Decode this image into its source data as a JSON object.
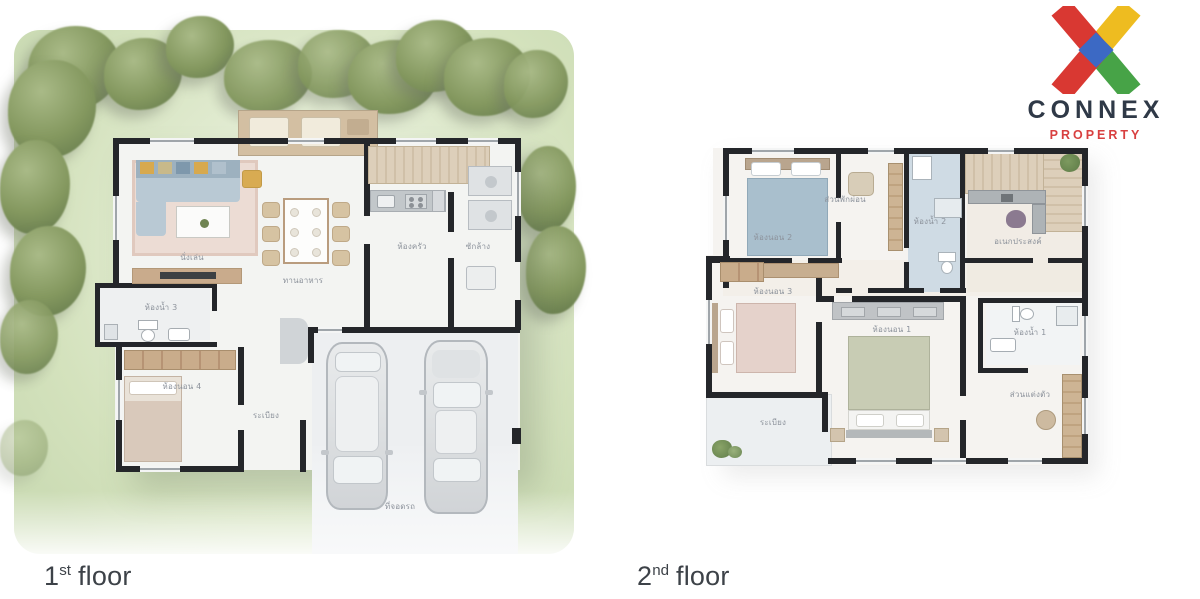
{
  "brand": {
    "logo_text": "CONNEX",
    "logo_subtext": "PROPERTY",
    "x_red": "#d93832",
    "x_yellow": "#eebc20",
    "x_green": "#47a347",
    "x_blue": "#3c69c4",
    "text_color": "#2f3947",
    "subtext_color": "#d84040"
  },
  "captions": {
    "floor1": {
      "number": "1",
      "ordinal": "st",
      "word": "floor"
    },
    "floor2": {
      "number": "2",
      "ordinal": "nd",
      "word": "floor"
    }
  },
  "floor1": {
    "rooms": {
      "living": {
        "label": "นั่งเล่น"
      },
      "dining": {
        "label": "ทานอาหาร"
      },
      "kitchen": {
        "label": "ห้องครัว"
      },
      "laundry": {
        "label": "ซักล้าง"
      },
      "bathroom3": {
        "label": "ห้องน้ำ 3"
      },
      "bedroom4": {
        "label": "ห้องนอน 4"
      },
      "walkway": {
        "label": "ระเบียง"
      },
      "carport": {
        "label": "ที่จอดรถ"
      }
    }
  },
  "floor2": {
    "rooms": {
      "bedroom2": {
        "label": "ห้องนอน 2"
      },
      "lounge": {
        "label": "ส่วนพักผ่อน"
      },
      "bathroom2": {
        "label": "ห้องน้ำ 2"
      },
      "multipurpose": {
        "label": "อเนกประสงค์"
      },
      "bedroom3": {
        "label": "ห้องนอน 3"
      },
      "bedroom1": {
        "label": "ห้องนอน 1"
      },
      "bathroom1": {
        "label": "ห้องน้ำ 1"
      },
      "dressing": {
        "label": "ส่วนแต่งตัว"
      },
      "balcony": {
        "label": "ระเบียง"
      }
    }
  }
}
